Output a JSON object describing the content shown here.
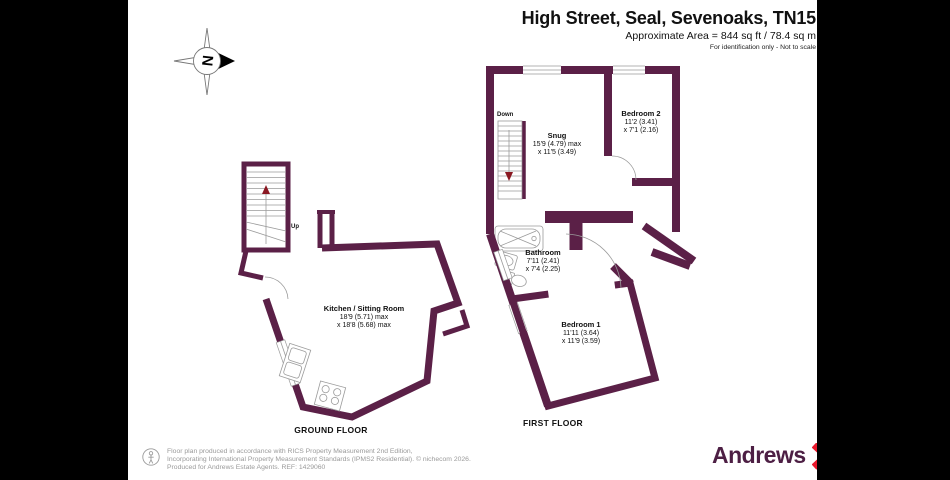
{
  "header": {
    "title": "High Street, Seal, Sevenoaks, TN15",
    "area": "Approximate Area = 844 sq ft / 78.4 sq m",
    "disclaimer": "For identification only - Not to scale"
  },
  "compass": {
    "north_letter": "N"
  },
  "floors": {
    "ground": {
      "label": "GROUND FLOOR",
      "stair_label": "Up",
      "rooms": {
        "kitchen": {
          "name": "Kitchen / Sitting Room",
          "dim1": "18'9 (5.71) max",
          "dim2": "x 18'8 (5.68) max"
        }
      }
    },
    "first": {
      "label": "FIRST FLOOR",
      "stair_label": "Down",
      "rooms": {
        "snug": {
          "name": "Snug",
          "dim1": "15'9 (4.79) max",
          "dim2": "x 11'5 (3.49)"
        },
        "bedroom2": {
          "name": "Bedroom 2",
          "dim1": "11'2 (3.41)",
          "dim2": "x 7'1 (2.16)"
        },
        "bathroom": {
          "name": "Bathroom",
          "dim1": "7'11 (2.41)",
          "dim2": "x 7'4 (2.25)"
        },
        "bedroom1": {
          "name": "Bedroom 1",
          "dim1": "11'11 (3.64)",
          "dim2": "x 11'9 (3.59)"
        }
      }
    }
  },
  "footer": {
    "line1": "Floor plan produced in accordance with RICS Property Measurement 2nd Edition,",
    "line2": "Incorporating International Property Measurement Standards (IPMS2 Residential).   © nichecom 2026.",
    "line3": "Produced for Andrews Estate Agents.   REF: 1429060"
  },
  "logo": {
    "name": "Andrews"
  },
  "colors": {
    "wall": "#5b2047",
    "logo_purple": "#4d1f44",
    "logo_red": "#e8192c"
  }
}
